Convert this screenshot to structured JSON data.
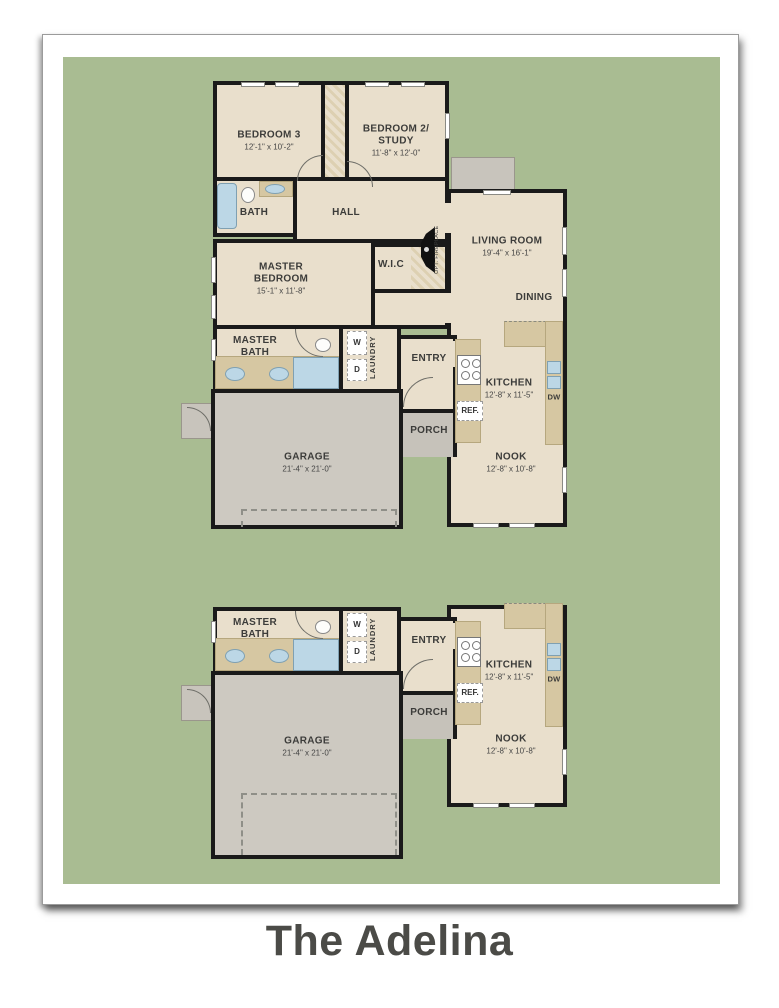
{
  "title": "The Adelina",
  "colors": {
    "background_green": "#a9bc92",
    "room_fill": "#e9dfcc",
    "counter_fill": "#d6c7a2",
    "garage_fill": "#cdc9c1",
    "wall_color": "#1a1a1a",
    "fixture_blue": "#bcd7e6",
    "title_color": "#4b4b47"
  },
  "plan_a": {
    "bedroom3": {
      "name": "BEDROOM 3",
      "dims": "12'-1\" x 10'-2\""
    },
    "bedroom2": {
      "line1": "BEDROOM 2/",
      "line2": "STUDY",
      "dims": "11'-8\" x 12'-0\""
    },
    "bath": {
      "name": "BATH"
    },
    "hall": {
      "name": "HALL"
    },
    "living": {
      "name": "LIVING ROOM",
      "dims": "19'-4\" x 16'-1\""
    },
    "dining": {
      "name": "DINING"
    },
    "fireplace": {
      "name": "OPT. FIREPLACE"
    },
    "master_bedroom": {
      "line1": "MASTER",
      "line2": "BEDROOM",
      "dims": "15'-1\" x 11'-8\""
    },
    "wic": {
      "name": "W.I.C"
    },
    "master_bath": {
      "line1": "MASTER",
      "line2": "BATH"
    },
    "laundry": {
      "name": "LAUNDRY",
      "washer": "W",
      "dryer": "D"
    },
    "entry": {
      "name": "ENTRY"
    },
    "kitchen": {
      "name": "KITCHEN",
      "dims": "12'-8\" x 11'-5\"",
      "ref": "REF.",
      "dw": "DW"
    },
    "porch": {
      "name": "PORCH"
    },
    "garage": {
      "name": "GARAGE",
      "dims": "21'-4\" x 21'-0\""
    },
    "nook": {
      "name": "NOOK",
      "dims": "12'-8\" x 10'-8\""
    }
  },
  "plan_b": {
    "master_bath": {
      "line1": "MASTER",
      "line2": "BATH"
    },
    "laundry": {
      "name": "LAUNDRY",
      "washer": "W",
      "dryer": "D"
    },
    "entry": {
      "name": "ENTRY"
    },
    "kitchen": {
      "name": "KITCHEN",
      "dims": "12'-8\" x 11'-5\"",
      "ref": "REF.",
      "dw": "DW"
    },
    "porch": {
      "name": "PORCH"
    },
    "garage": {
      "name": "GARAGE",
      "dims": "21'-4\" x 21'-0\""
    },
    "nook": {
      "name": "NOOK",
      "dims": "12'-8\" x 10'-8\""
    }
  }
}
